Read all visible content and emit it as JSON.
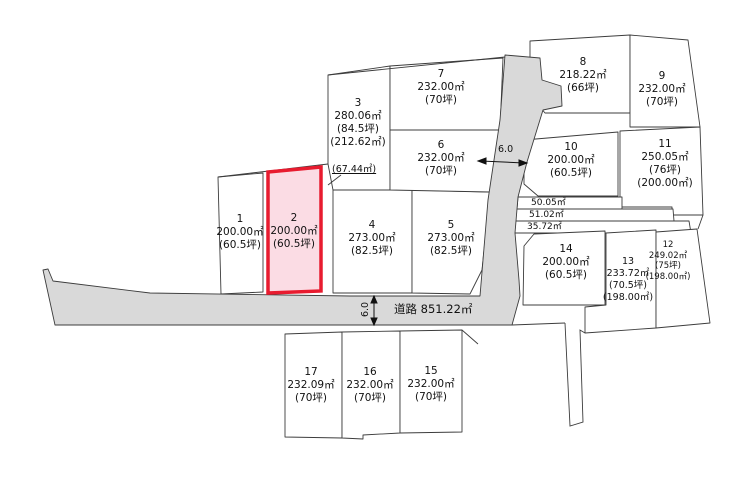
{
  "colors": {
    "line": "#3c3c3c",
    "road_fill": "#d9d9d9",
    "highlight_stroke": "#e81b2f",
    "highlight_fill": "#fbdce4",
    "lot_fill": "#ffffff",
    "text": "#111111"
  },
  "road": {
    "label": "道路 851.22㎡"
  },
  "dimensions": {
    "width_top": "6.0",
    "width_bottom": "6.0"
  },
  "strips": {
    "s1": {
      "label": "50.05㎡"
    },
    "s2": {
      "label": "51.02㎡"
    },
    "s3": {
      "label": "35.72㎡"
    }
  },
  "note": {
    "label": "(67.44㎡)"
  },
  "lots": {
    "L1": {
      "no": "1",
      "area": "200.00㎡",
      "tsubo": "(60.5坪)"
    },
    "L2": {
      "no": "2",
      "area": "200.00㎡",
      "tsubo": "(60.5坪)"
    },
    "L3": {
      "no": "3",
      "area": "280.06㎡",
      "tsubo": "(84.5坪)",
      "alt": "(212.62㎡)"
    },
    "L4": {
      "no": "4",
      "area": "273.00㎡",
      "tsubo": "(82.5坪)"
    },
    "L5": {
      "no": "5",
      "area": "273.00㎡",
      "tsubo": "(82.5坪)"
    },
    "L6": {
      "no": "6",
      "area": "232.00㎡",
      "tsubo": "(70坪)"
    },
    "L7": {
      "no": "7",
      "area": "232.00㎡",
      "tsubo": "(70坪)"
    },
    "L8": {
      "no": "8",
      "area": "218.22㎡",
      "tsubo": "(66坪)"
    },
    "L9": {
      "no": "9",
      "area": "232.00㎡",
      "tsubo": "(70坪)"
    },
    "L10": {
      "no": "10",
      "area": "200.00㎡",
      "tsubo": "(60.5坪)"
    },
    "L11": {
      "no": "11",
      "area": "250.05㎡",
      "tsubo": "(76坪)",
      "alt": "(200.00㎡)"
    },
    "L12": {
      "no": "12",
      "area": "249.02㎡",
      "tsubo": "(75坪)",
      "alt": "(198.00㎡)"
    },
    "L13": {
      "no": "13",
      "area": "233.72㎡",
      "tsubo": "(70.5坪)",
      "alt": "(198.00㎡)"
    },
    "L14": {
      "no": "14",
      "area": "200.00㎡",
      "tsubo": "(60.5坪)"
    },
    "L15": {
      "no": "15",
      "area": "232.00㎡",
      "tsubo": "(70坪)"
    },
    "L16": {
      "no": "16",
      "area": "232.00㎡",
      "tsubo": "(70坪)"
    },
    "L17": {
      "no": "17",
      "area": "232.09㎡",
      "tsubo": "(70坪)"
    }
  }
}
